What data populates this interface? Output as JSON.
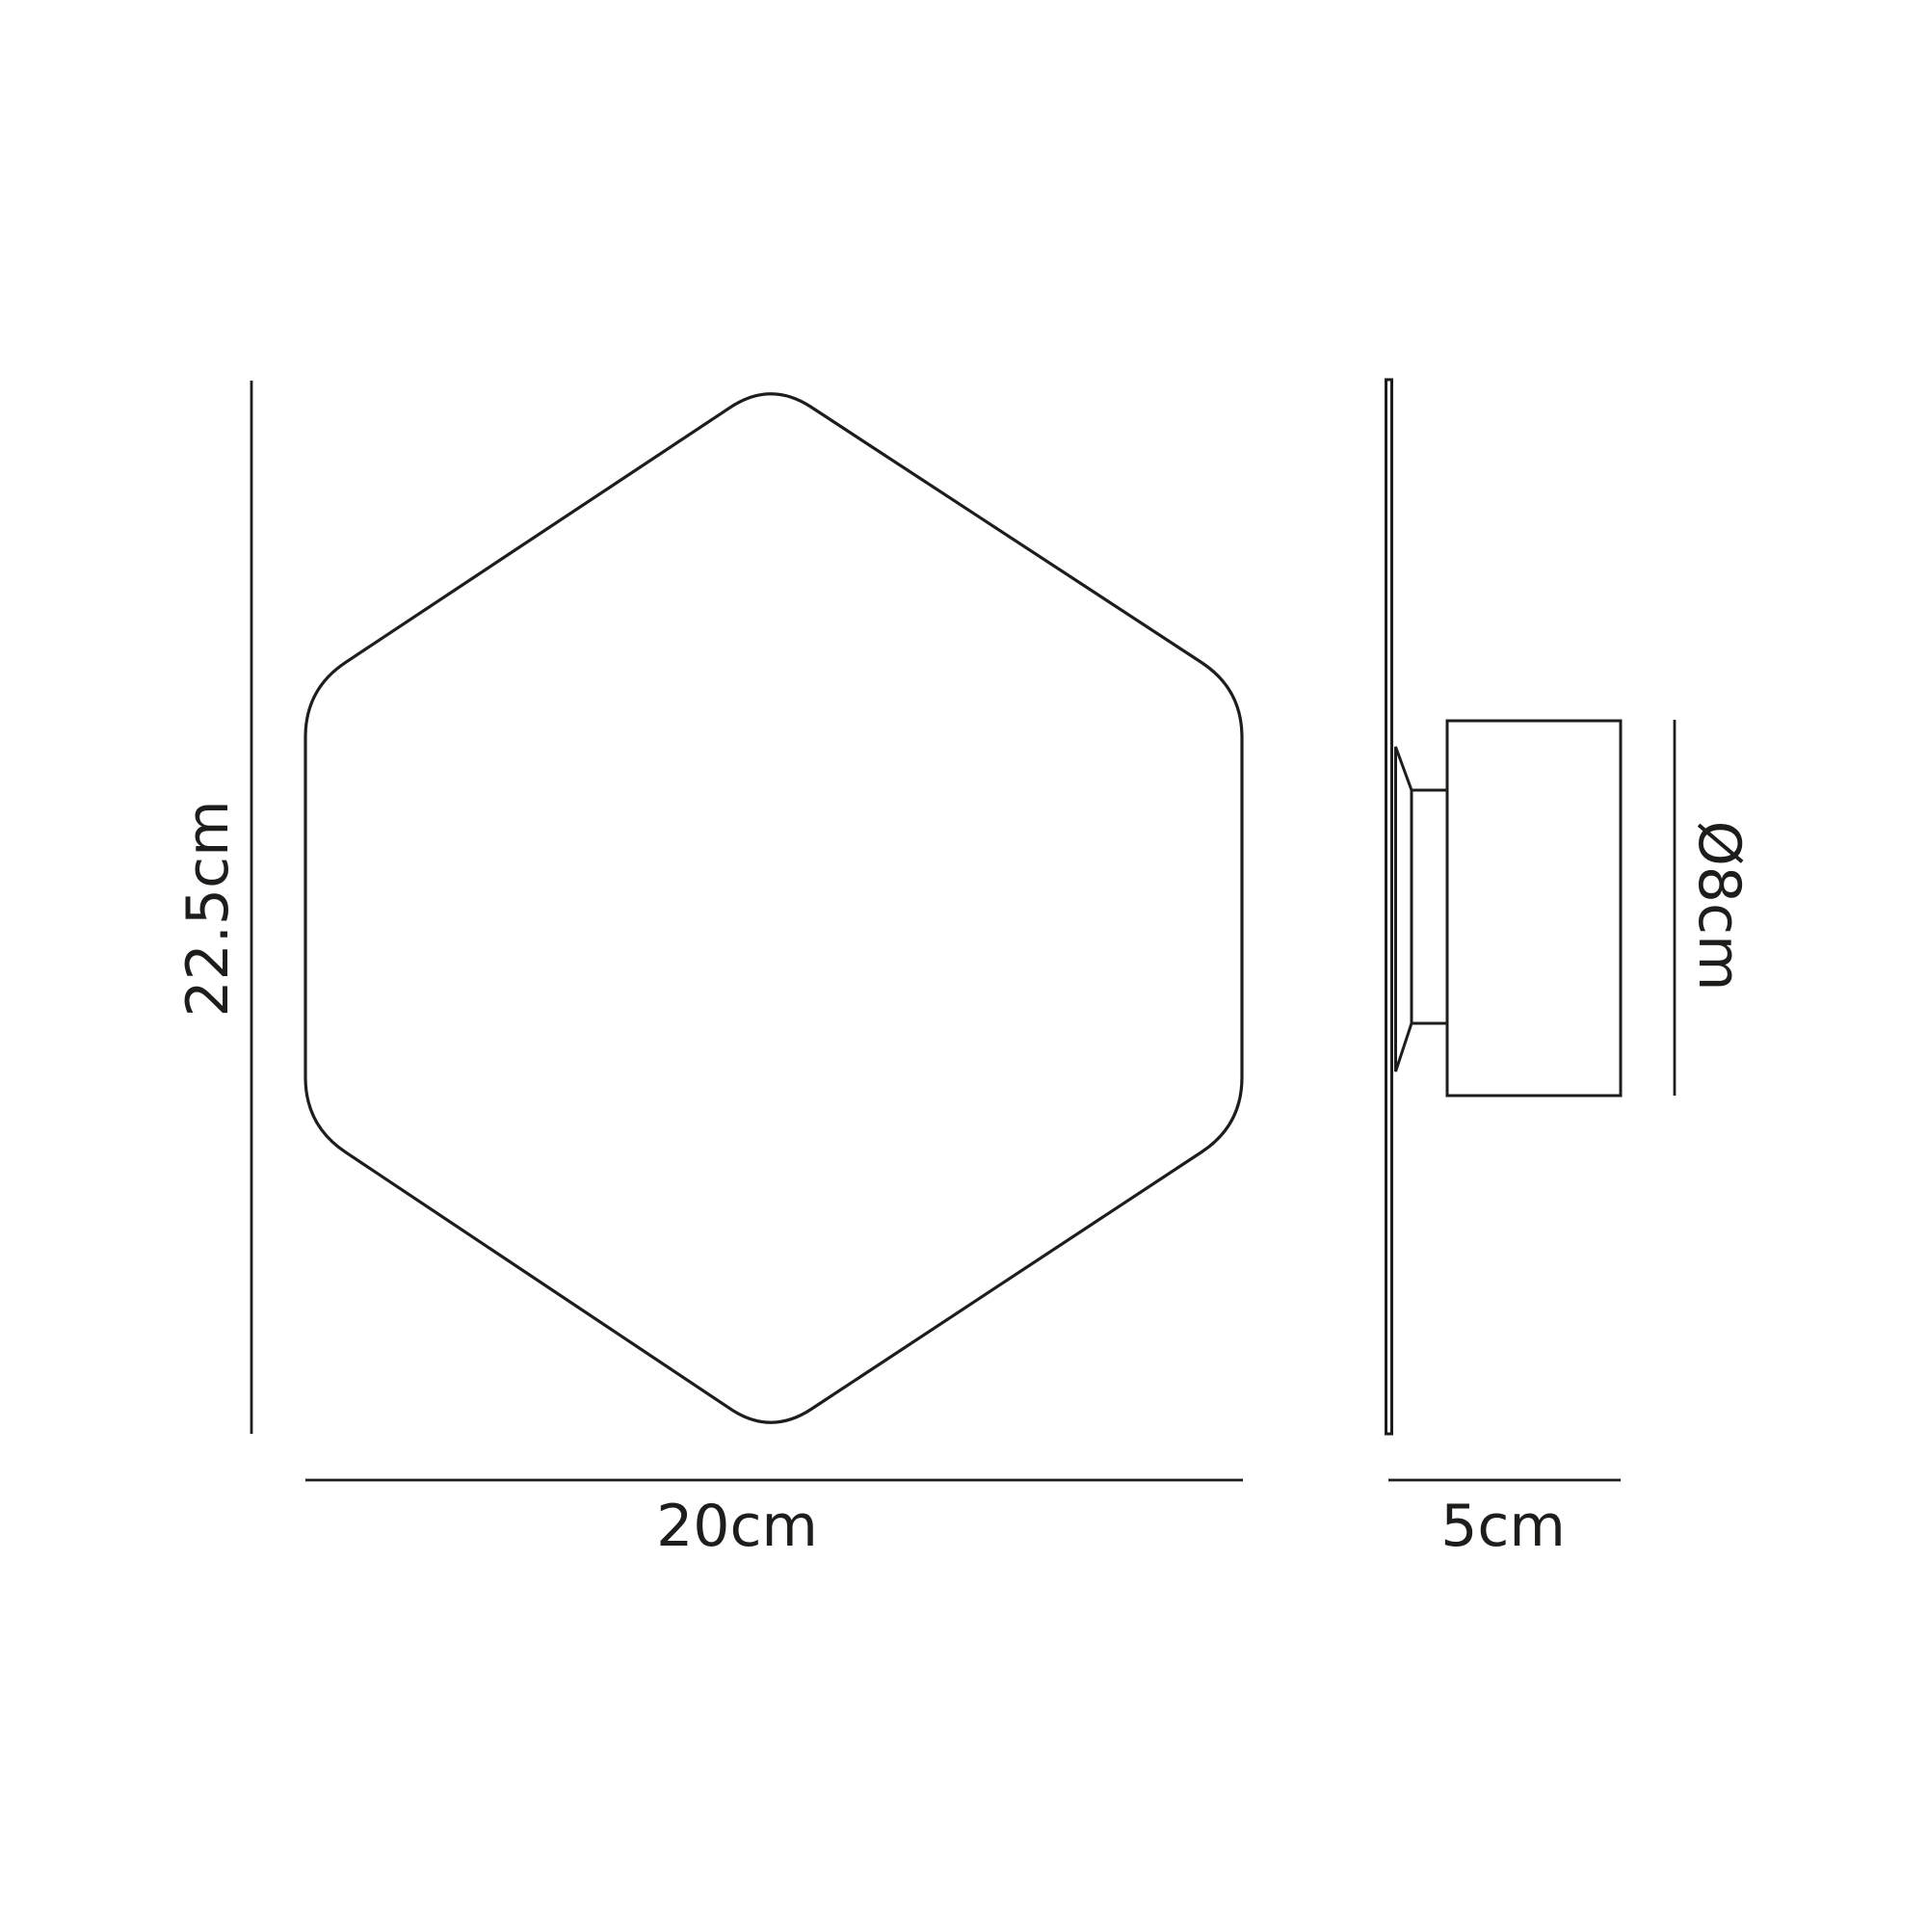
{
  "colors": {
    "line": "#1d1d1b",
    "background": "#ffffff"
  },
  "front_view": {
    "height_label": "22.5cm",
    "width_label": "20cm"
  },
  "side_view": {
    "diameter_label": "Ø8cm",
    "depth_label": "5cm"
  }
}
